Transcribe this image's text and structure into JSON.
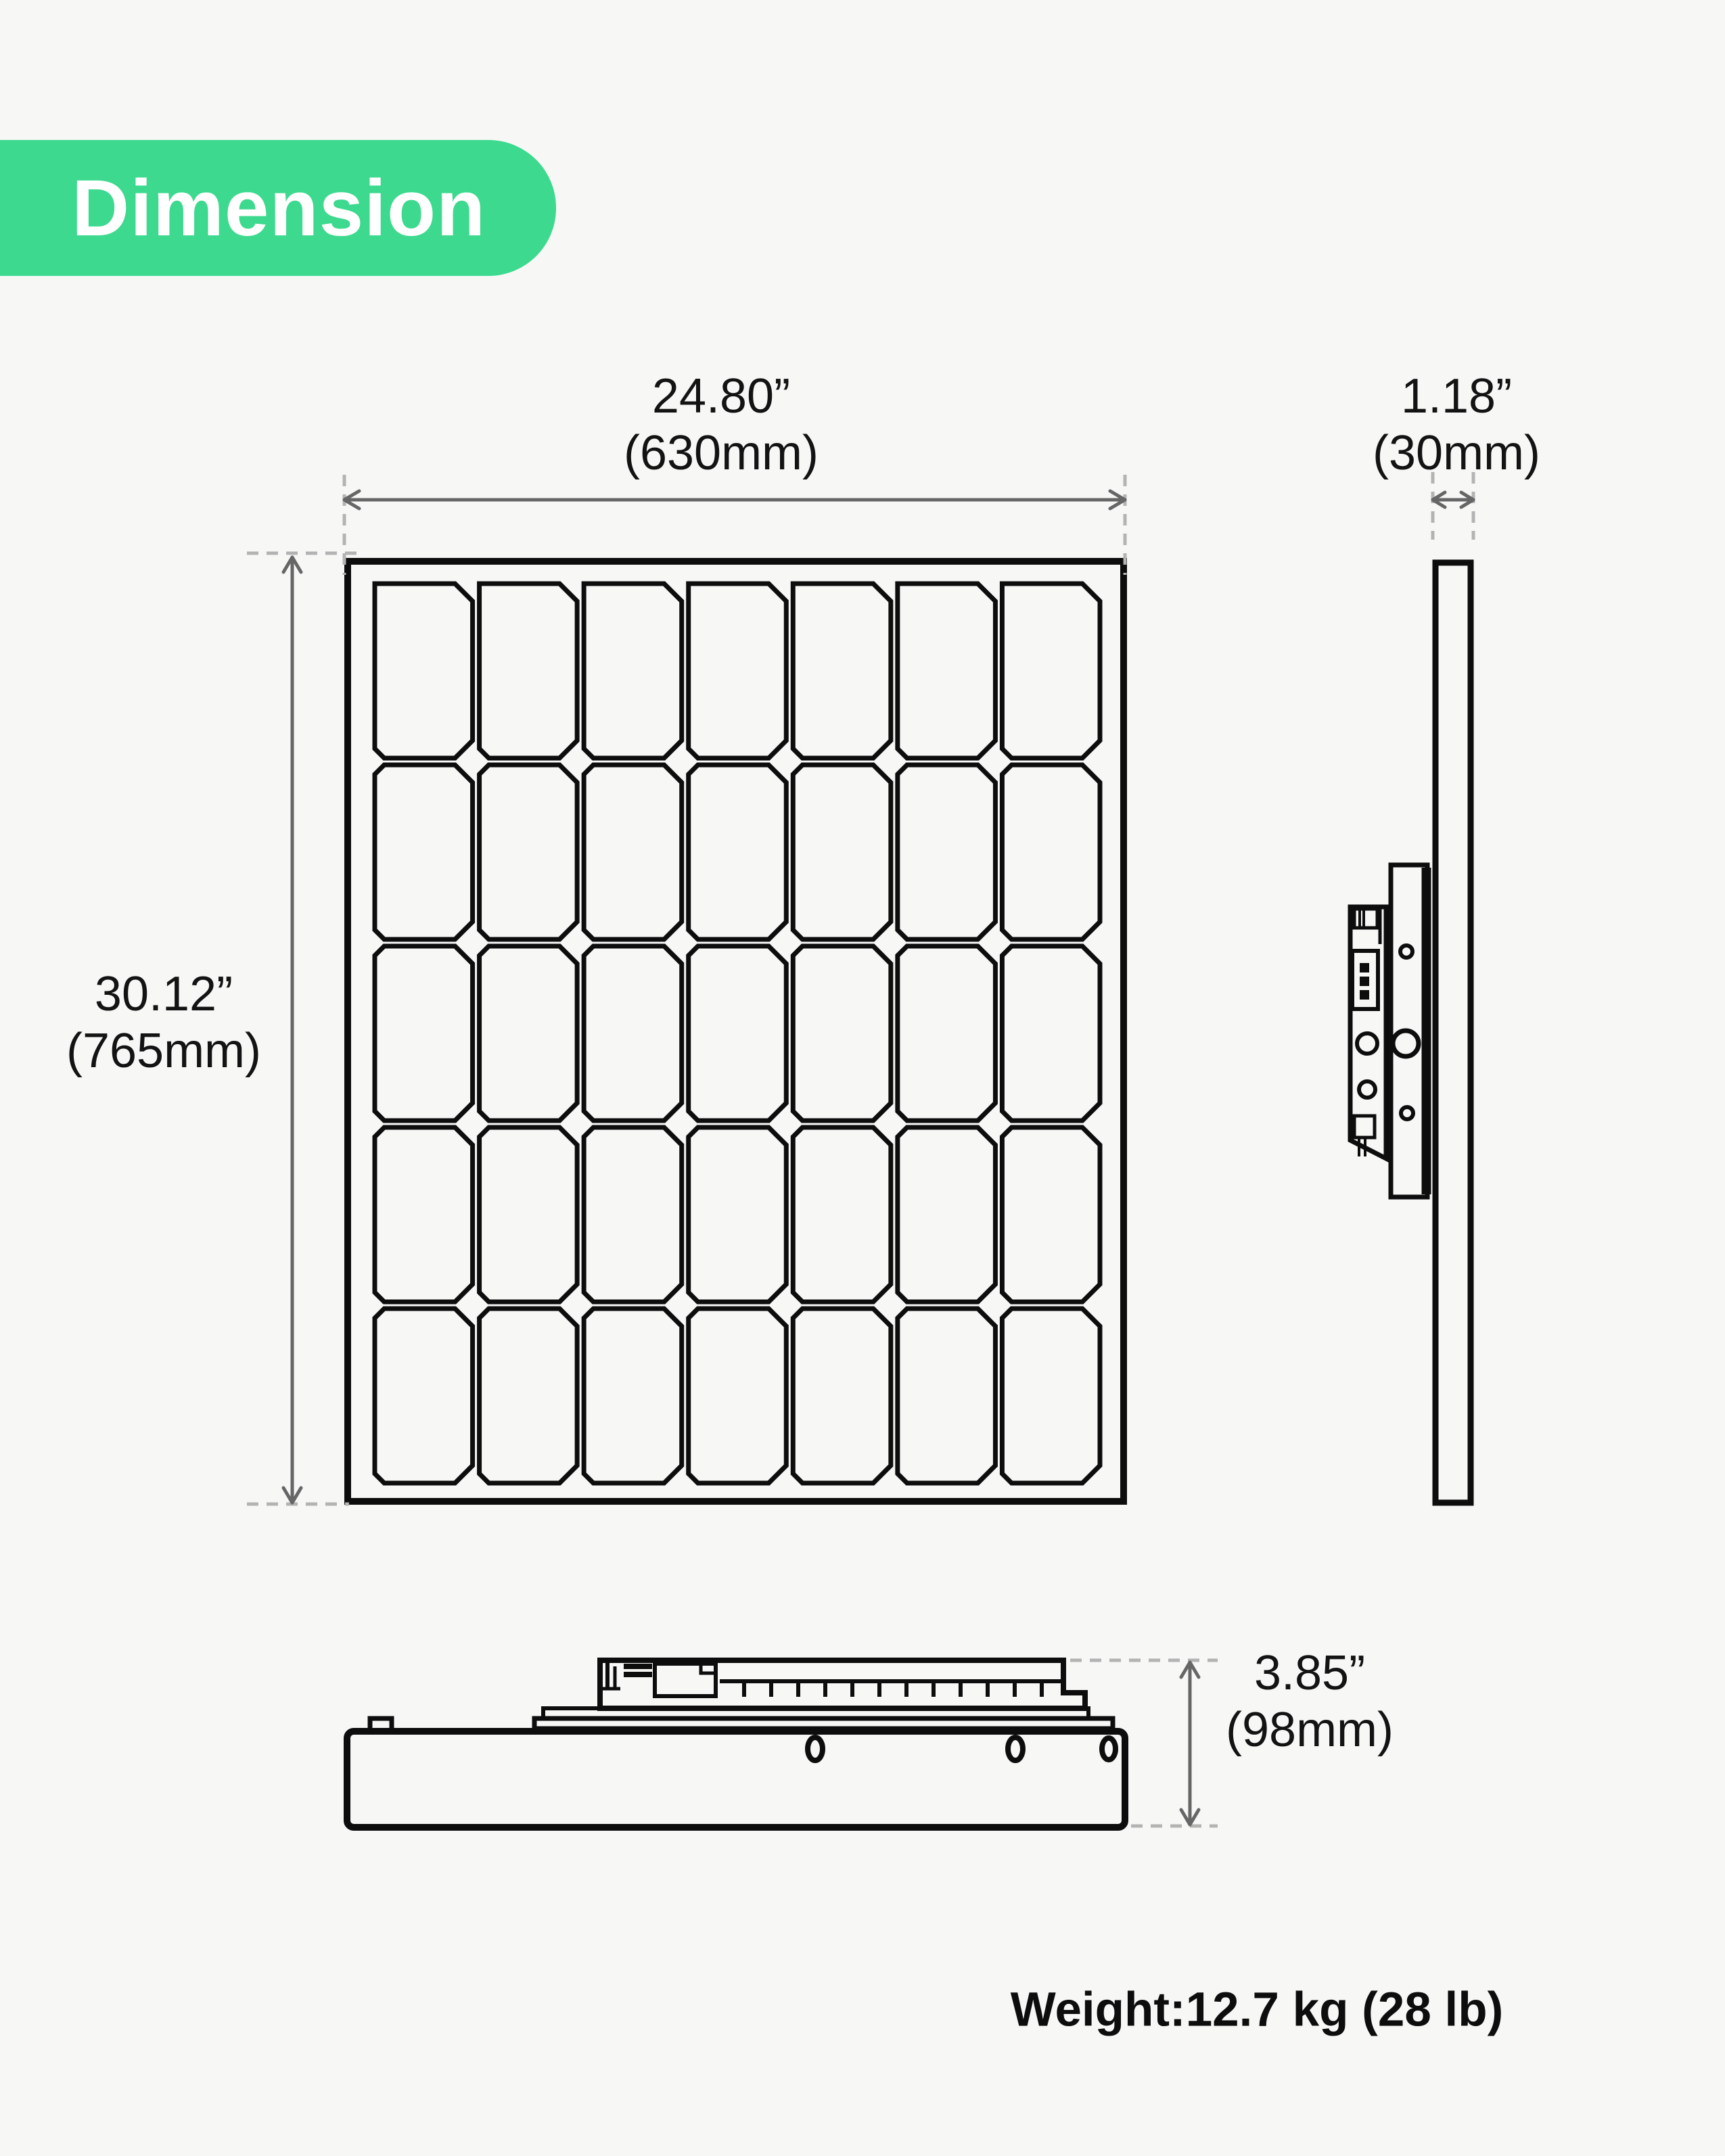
{
  "badge": {
    "label": "Dimension",
    "bg_color": "#3cd98e",
    "text_color": "#ffffff"
  },
  "views": {
    "front": {
      "name": "solar-panel-front-view",
      "cell_grid": {
        "columns": 7,
        "rows": 5
      }
    },
    "side": {
      "name": "solar-panel-side-view"
    },
    "bottom": {
      "name": "solar-panel-bottom-view"
    }
  },
  "dimensions": {
    "width": {
      "inches": "24.80”",
      "metric": "(630mm)"
    },
    "thickness": {
      "inches": "1.18”",
      "metric": "(30mm)"
    },
    "height": {
      "inches": "30.12”",
      "metric": "(765mm)"
    },
    "depth": {
      "inches": "3.85”",
      "metric": "(98mm)"
    }
  },
  "weight": {
    "label": "Weight:12.7 kg (28 lb)"
  },
  "colors": {
    "background": "#f7f8f6",
    "line": "#0d0d0d",
    "dimension_line": "#666666",
    "extension_dash": "#b3b3b3",
    "accent": "#3cd98e"
  }
}
